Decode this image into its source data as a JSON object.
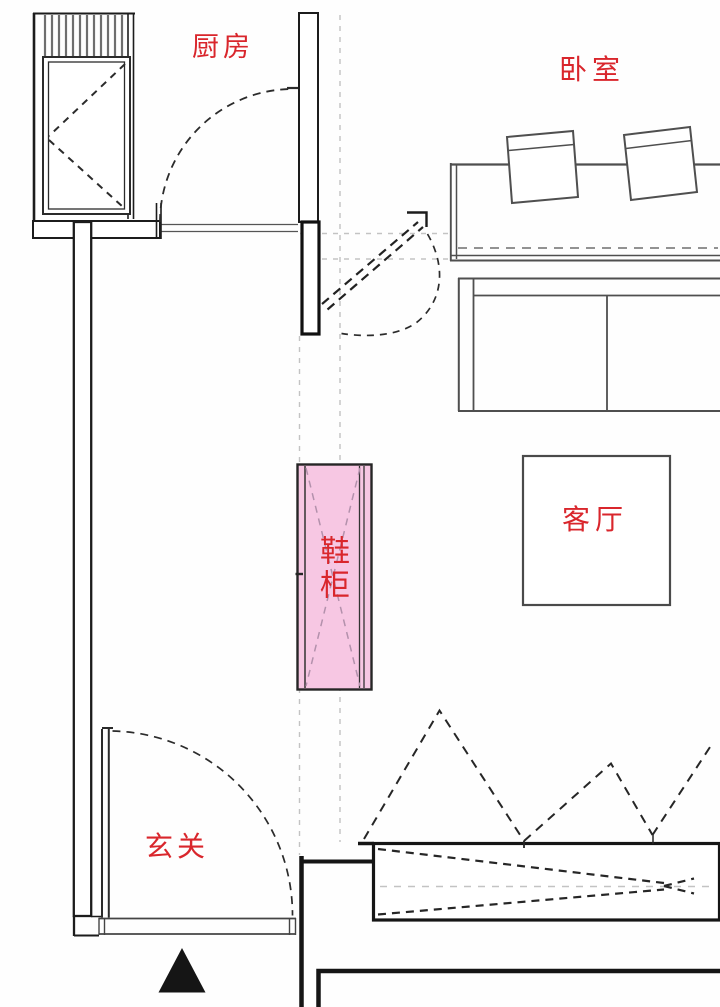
{
  "plan": {
    "rooms": {
      "kitchen": "厨房",
      "bedroom": "卧室",
      "living_room": "客厅",
      "entryway": "玄关"
    },
    "highlight_cabinet": {
      "label": "鞋柜",
      "fill": "#f7c7e3",
      "border": "#262626"
    },
    "colors": {
      "label_red": "#d9262c",
      "wall_dark": "#1c1c1c",
      "furniture_gray": "#4f4f4f",
      "guide_gray": "#c3c3c3",
      "cross_hatch_purple": "#b391ac",
      "triangle_black": "#151515"
    },
    "symbols": {
      "entrance_marker": "filled-up-triangle",
      "door_swing": "dashed-quarter-arc",
      "cabinet_front": "dashed-x-cross",
      "folding_doors": "dashed-peaks"
    }
  }
}
